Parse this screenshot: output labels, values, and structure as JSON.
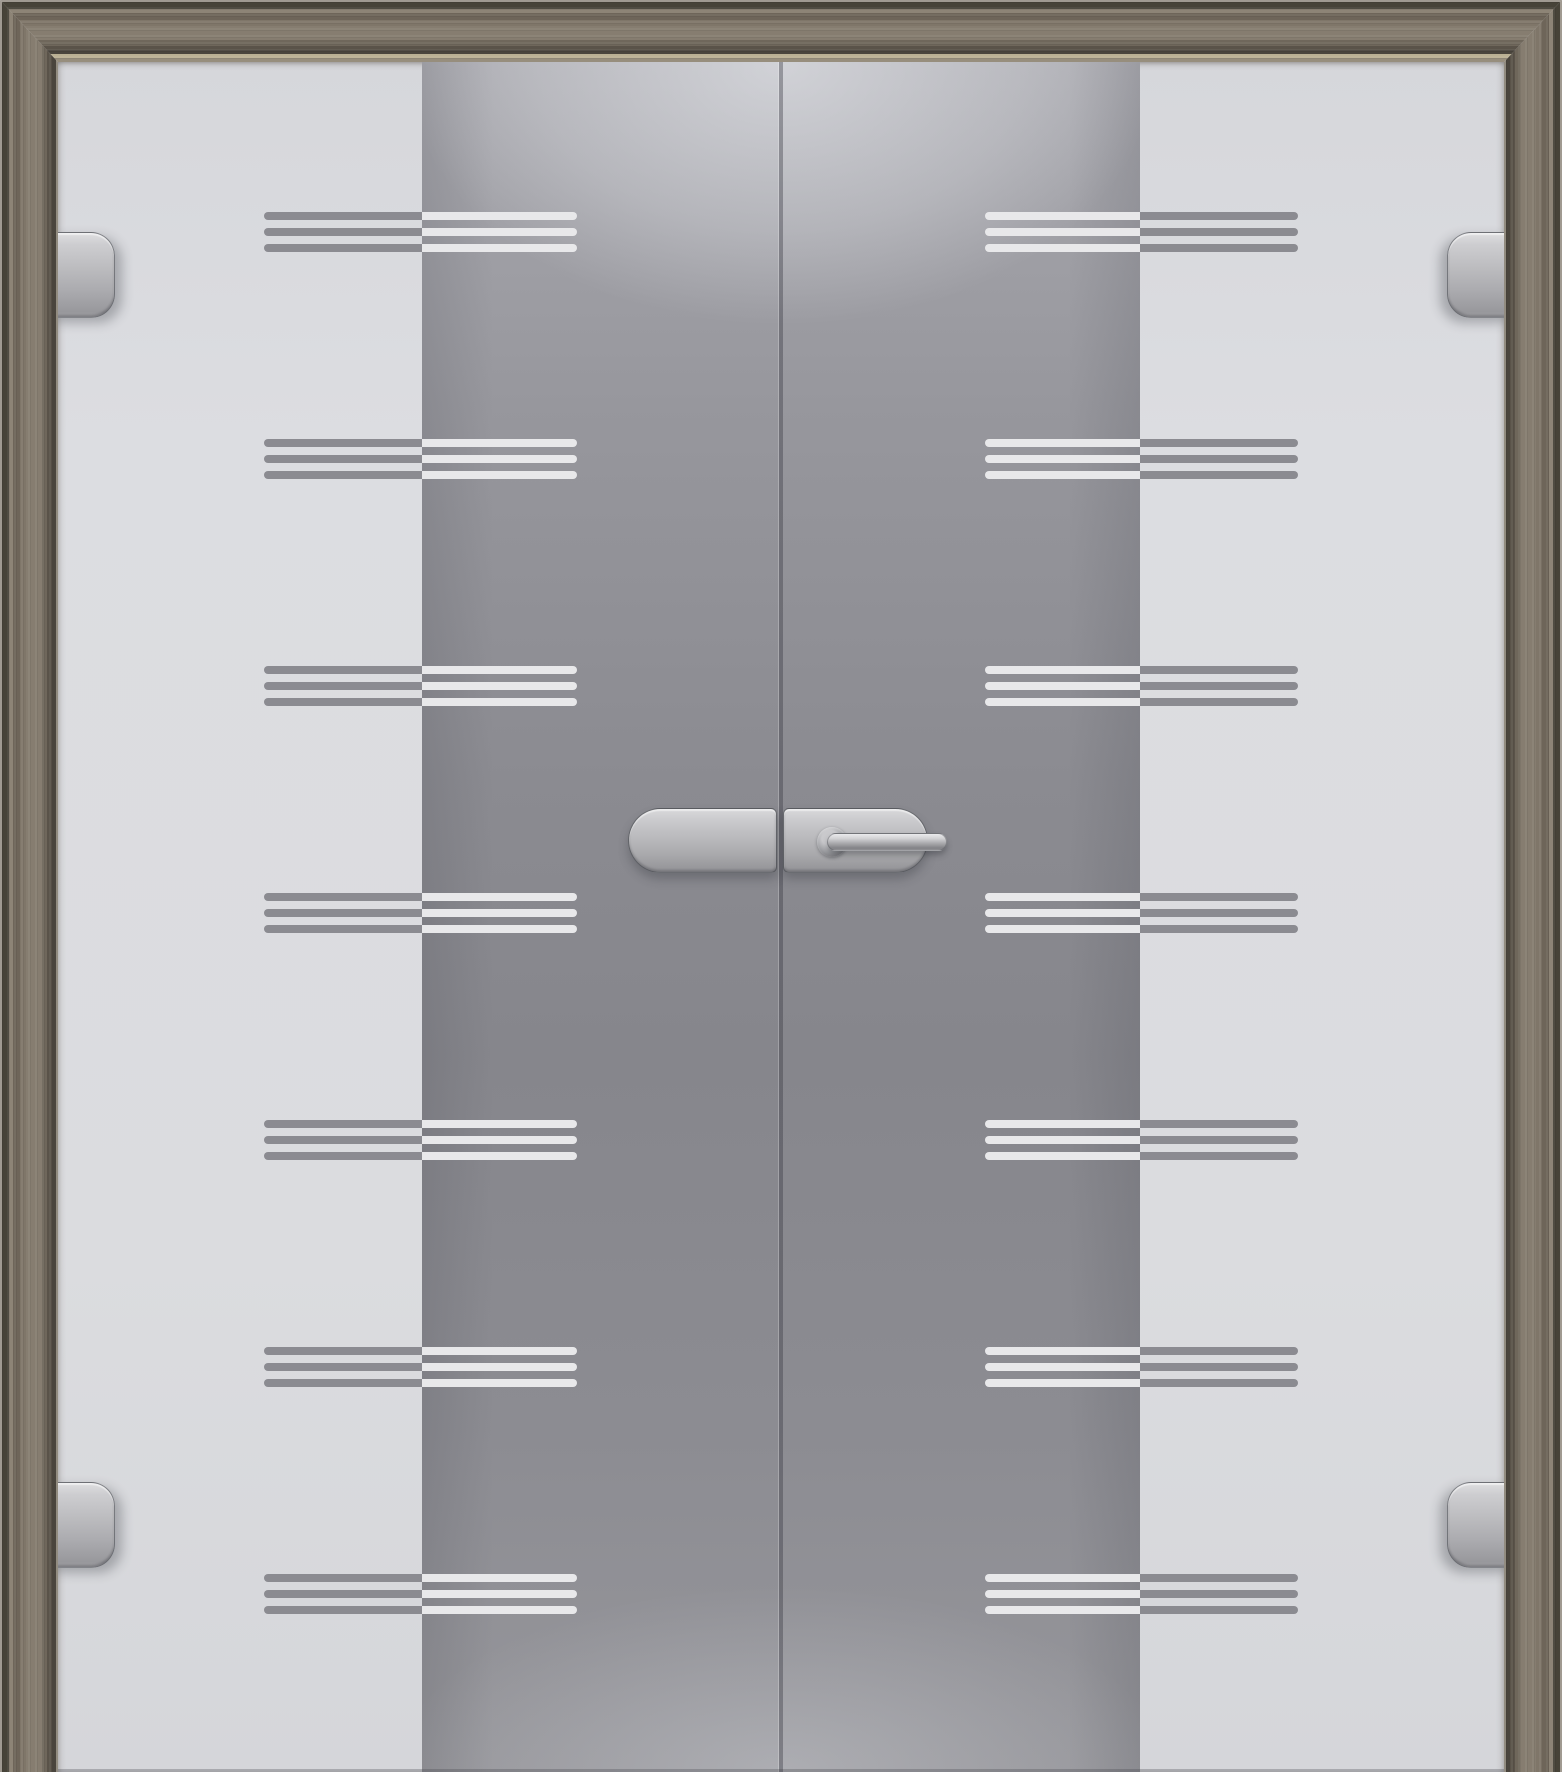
{
  "scene": {
    "subject": "double-leaf glass swing door in grey walnut wood frame",
    "decor": "frosted horizontal triple-stripe rows on satin gradient band",
    "visible_text": ""
  },
  "colors": {
    "glass_light": "#dbdcdf",
    "band_top": "#a8a8ae",
    "band_mid": "#86868c",
    "band_bottom": "#96969b",
    "stripe_grey": "#8b8b91",
    "stripe_white": "#e8e8ea",
    "frame_face": "#7f7669",
    "frame_dark_edge": "#474338",
    "frame_rebate": "#bab094",
    "metal_light": "#dedee0",
    "metal_dark": "#929296"
  },
  "glass": {
    "left": 58,
    "top": 62,
    "width": 1446,
    "height": 1710,
    "band_left": 422,
    "band_right": 1140,
    "seam_x": 778,
    "seam_width": 5
  },
  "pattern": {
    "rows_y": [
      232,
      459,
      686,
      913,
      1140,
      1367,
      1594
    ],
    "group_width": 313,
    "line_height": 8,
    "line_spacing": 16,
    "left_group_x": 264,
    "right_group_x": 985,
    "left_boundary_px": 158,
    "right_boundary_px": 155
  },
  "hardware": {
    "hinges": [
      {
        "name": "hinge-top-left",
        "x": 32,
        "y": 232,
        "side": "left"
      },
      {
        "name": "hinge-top-right",
        "x": 1447,
        "y": 232,
        "side": "right"
      },
      {
        "name": "hinge-bottom-left",
        "x": 32,
        "y": 1482,
        "side": "left"
      },
      {
        "name": "hinge-bottom-right",
        "x": 1447,
        "y": 1482,
        "side": "right"
      }
    ],
    "hinge_size": {
      "width": 83,
      "height": 86
    },
    "handle": {
      "left_plate": {
        "x": 628,
        "y": 808,
        "width": 149,
        "height": 65
      },
      "right_plate": {
        "x": 783,
        "y": 808,
        "width": 145,
        "height": 65
      },
      "lever": {
        "x": 827,
        "y": 833,
        "width": 120,
        "height": 18
      },
      "rosette": {
        "cx": 832,
        "cy": 842,
        "r": 15
      }
    }
  }
}
